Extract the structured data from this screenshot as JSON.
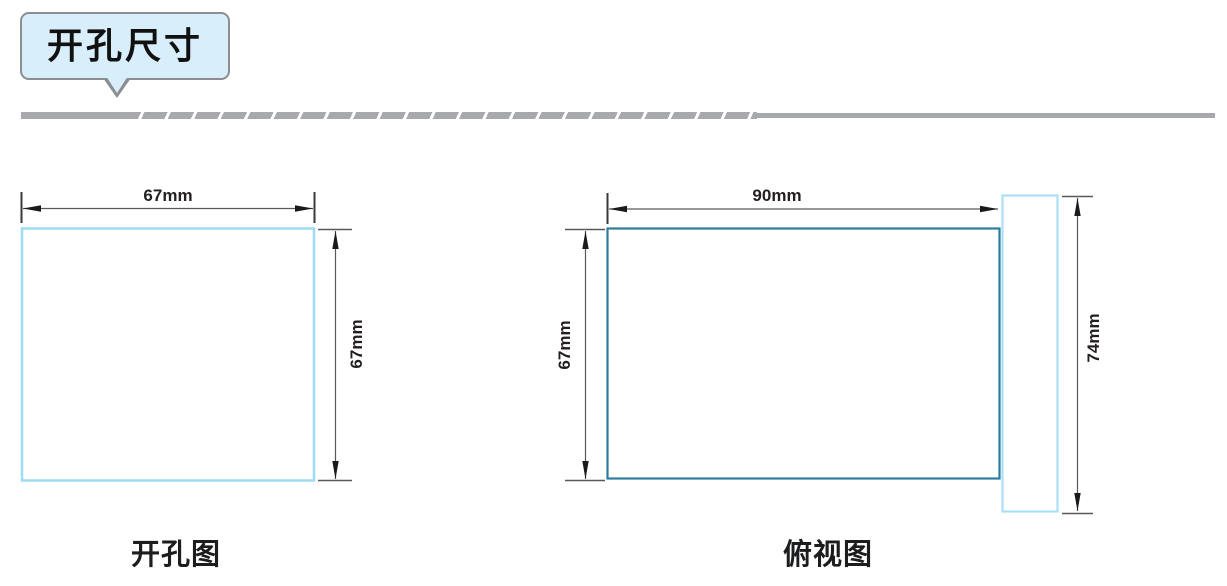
{
  "page": {
    "background": "#ffffff"
  },
  "header": {
    "title": "开孔尺寸",
    "bubble_fill": "#d9eefb",
    "bubble_border": "#8b8e91",
    "text_color": "#111111"
  },
  "divider": {
    "color": "#a7a9ac",
    "style": "slashed-bar"
  },
  "dimension_style": {
    "line_color": "#58595b",
    "arrow_color": "#1a1a1a",
    "label_color": "#231f20"
  },
  "figures": [
    {
      "caption": "开孔图",
      "dimensions": {
        "width": "67mm",
        "height": "67mm"
      },
      "colors": {
        "outline": "#9edcf4"
      }
    },
    {
      "caption": "俯视图",
      "dimensions": {
        "width": "90mm",
        "height": "67mm",
        "overall": "74mm"
      },
      "colors": {
        "body_outline": "#2e7b9c",
        "flange_outline": "#a9e0f7"
      }
    }
  ]
}
